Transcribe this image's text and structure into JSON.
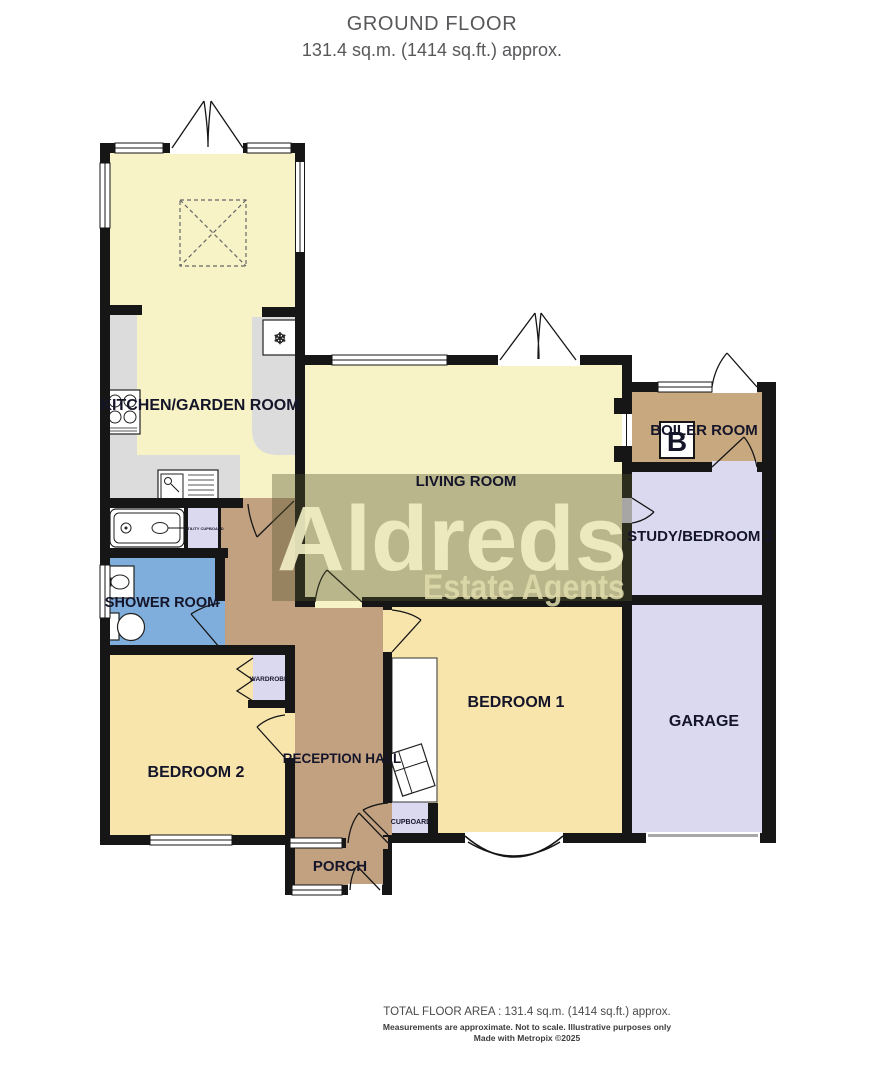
{
  "header": {
    "title": "GROUND FLOOR",
    "subtitle": "131.4 sq.m. (1414 sq.ft.) approx."
  },
  "watermark": {
    "brand": "Aldreds",
    "tagline": "Estate Agents"
  },
  "rooms": {
    "kitchen": {
      "label": "KITCHEN/GARDEN ROOM"
    },
    "living": {
      "label": "LIVING ROOM"
    },
    "boiler": {
      "label": "BOILER ROOM"
    },
    "study": {
      "label": "STUDY/BEDROOM 3"
    },
    "shower": {
      "label": "SHOWER ROOM"
    },
    "bedroom1": {
      "label": "BEDROOM 1"
    },
    "bedroom2": {
      "label": "BEDROOM 2"
    },
    "hall": {
      "label": "RECEPTION HALL"
    },
    "garage": {
      "label": "GARAGE"
    },
    "porch": {
      "label": "PORCH"
    },
    "cupboard": {
      "label": "CUPBOARD"
    },
    "wardrobe": {
      "label": "WARDROBE"
    },
    "utility": {
      "label": "UTILITY CUPBOARD"
    }
  },
  "symbols": {
    "boiler_letter": "B",
    "freezer_glyph": "❄"
  },
  "colors": {
    "pale_yellow": "#F7F3C6",
    "gold": "#F8E5AC",
    "hall_brown": "#C2A181",
    "boiler_tan": "#C8A87E",
    "lavender": "#DBD9EF",
    "shower_blue": "#7FAEDC",
    "counter_gray": "#DCDCDC",
    "wall": "#161616",
    "label_text": "#15152A",
    "watermark_band": "rgba(85,84,44,0.38)",
    "watermark_text": "#F2EFC5",
    "watermark_tag": "#E0DCAC"
  },
  "footer": {
    "line1": "TOTAL FLOOR AREA : 131.4 sq.m. (1414 sq.ft.) approx.",
    "line2": "Measurements are approximate.  Not to scale.  Illustrative purposes only",
    "line3": "Made with Metropix ©2025"
  }
}
